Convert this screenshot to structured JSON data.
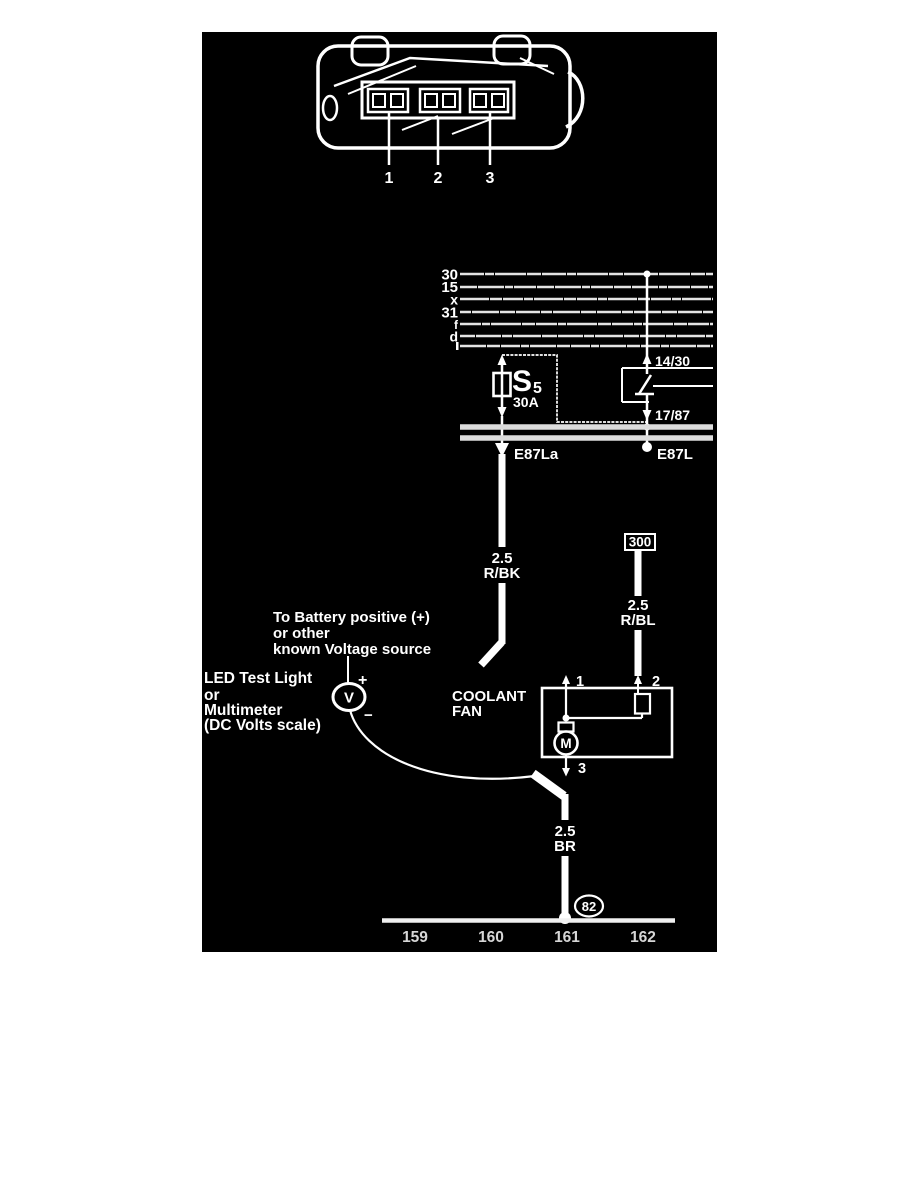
{
  "colors": {
    "page_bg": "#ffffff",
    "diagram_bg": "#000000",
    "ink": "#ffffff",
    "rail_gray": "#dcdcdc"
  },
  "connector_view": {
    "pin_labels": [
      "1",
      "2",
      "3"
    ]
  },
  "power_rails": {
    "labels": [
      "30",
      "15",
      "x",
      "31",
      "f",
      "d"
    ]
  },
  "fuse": {
    "id": "S",
    "id_sub": "5",
    "rating": "30A"
  },
  "relay": {
    "terminal_top": "14/30",
    "terminal_bottom": "17/87"
  },
  "panel": {
    "fuse_terminal": "E87La",
    "relay_terminal": "E87L"
  },
  "wires": {
    "supply": {
      "size": "2.5",
      "color_code": "R/BK"
    },
    "fan_feed": {
      "size": "2.5",
      "color_code": "R/BL"
    },
    "ground": {
      "size": "2.5",
      "color_code": "BR"
    }
  },
  "inline_connector": {
    "id": "300"
  },
  "battery_note": {
    "line1": "To Battery positive (+)",
    "line2": "or other",
    "line3": "known Voltage source"
  },
  "meter_note": {
    "line1": "LED Test Light",
    "line2": "or",
    "line3": "Multimeter",
    "line4": "(DC Volts scale)"
  },
  "meter": {
    "symbol": "V",
    "plus": "+",
    "minus": "−"
  },
  "fan": {
    "name_line1": "COOLANT",
    "name_line2": "FAN",
    "pin1": "1",
    "pin2": "2",
    "pin3": "3",
    "motor_symbol": "M"
  },
  "ground_point": {
    "id": "82"
  },
  "tracks": {
    "labels": [
      "159",
      "160",
      "161",
      "162"
    ]
  }
}
